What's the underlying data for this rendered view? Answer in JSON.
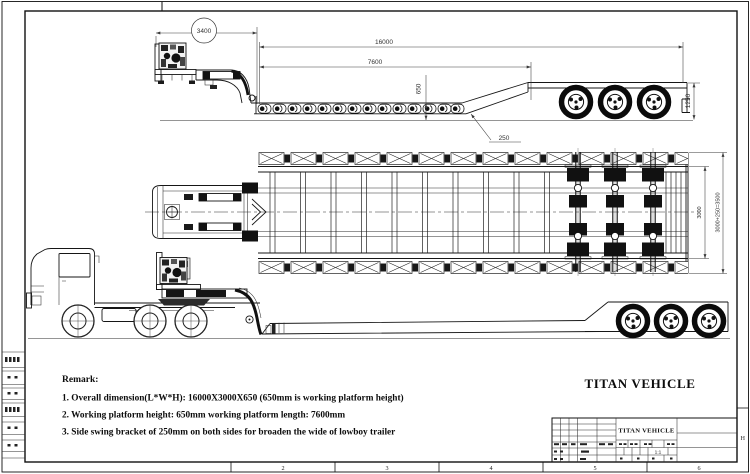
{
  "sheet": {
    "bottom_zone_labels": [
      "2",
      "3",
      "4",
      "5",
      "6"
    ],
    "right_zone_label": "H"
  },
  "dimensions": {
    "side_view": {
      "gooseneck_length": "3400",
      "overall_length": "16000",
      "platform_length": "7600",
      "platform_height": "650",
      "rear_deck_height": "1250",
      "side_bracket_width": "250"
    },
    "plan_view": {
      "platform_width": "3000",
      "overall_width": "3000+250=3500"
    }
  },
  "remark": {
    "title": "Remark:",
    "items": [
      "1. Overall dimension(L*W*H): 16000X3000X650 (650mm is working platform height)",
      "2. Working platform height: 650mm working platform length: 7600mm",
      "3. Side swing bracket of 250mm on both sides for broaden the wide of lowboy trailer"
    ]
  },
  "branding": {
    "main_title": "TITAN VEHICLE"
  },
  "title_block": {
    "company": "TITAN VEHICLE",
    "scale": "1:1"
  }
}
